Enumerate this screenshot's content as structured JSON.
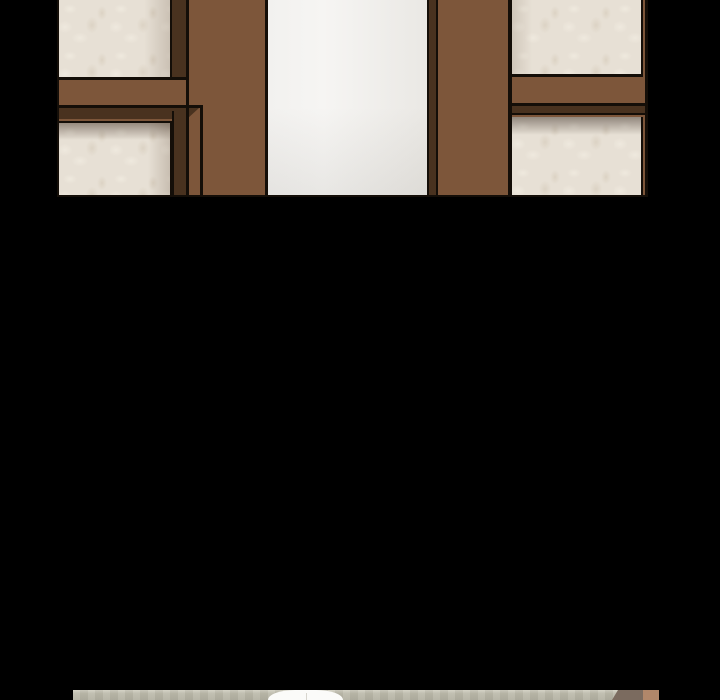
{
  "scene": {
    "type": "webtoon-reader-viewport",
    "description": "Vertical comic strip view. Top panel: interior wall with brown wood wainscot framing, floral cream wallpaper inserts and a bright white open doorway in the center. Long solid black gutter below. Bottom edge of viewport shows the first sliver of the next panel: sage-green wall top, the white crown of a speech bubble, and wood-toned shapes at the right.",
    "colors": {
      "gutter": "#000000",
      "outline": "#140e08",
      "wood": "#7d563a",
      "wood_dark": "#49321f",
      "wallpaper": "#e7e0d5",
      "wallpaper_hi": "#efe9de",
      "wallpaper_lo": "#dcd3c4",
      "doorway": "#f2f1ef",
      "sage": "#bcbaab",
      "sage_hi": "#d2d0c2",
      "taupe": "#7b6b5f",
      "tan": "#b1876a",
      "bubble": "#fbfbf9"
    },
    "panels": {
      "top_panel": {
        "regions": [
          "upper-left wallpaper insert",
          "lower-left wallpaper insert",
          "left wood stile",
          "white doorway opening",
          "doorway dark return edge",
          "right wood stile",
          "upper-right wallpaper insert",
          "lower-right wallpaper insert",
          "horizontal wood rail with dark beveled frame edges"
        ]
      },
      "bottom_panel_peek": {
        "regions": [
          "sage wall top edge",
          "speech-bubble crown",
          "taupe wood shape",
          "tan wood shape"
        ]
      }
    }
  }
}
